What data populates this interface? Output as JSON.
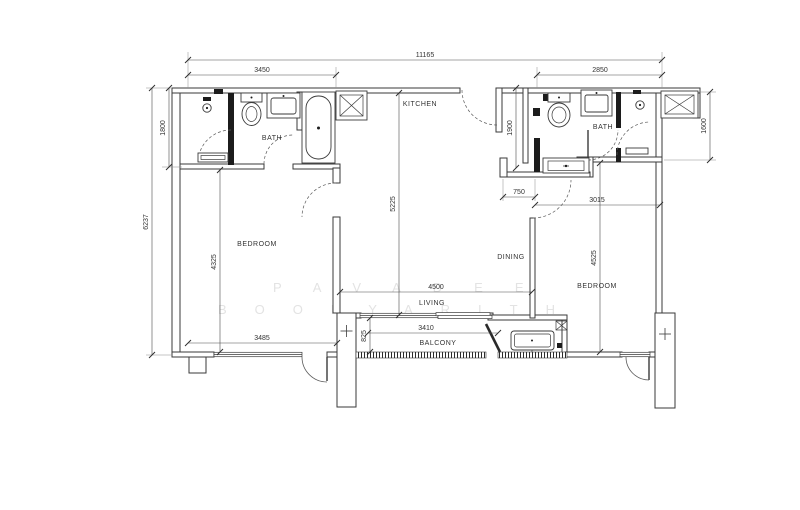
{
  "watermark": {
    "line1": "PAVADEE",
    "line2": "BOONYARITH"
  },
  "rooms": {
    "kitchen": "KITCHEN",
    "bath_left": "BATH",
    "bath_right": "BATH",
    "bedroom_left": "BEDROOM",
    "bedroom_right": "BEDROOM",
    "dining": "DINING",
    "living": "LIVING",
    "balcony": "BALCONY"
  },
  "dimensions_mm": {
    "overall_width": "11165",
    "left_section_width": "3450",
    "right_section_width": "2850",
    "overall_left_height": "6237",
    "bath_left_depth": "1800",
    "foyer_depth": "1900",
    "shaft_right_depth": "1600",
    "kitchen_living_depth": "5225",
    "bedroom_left_length": "4325",
    "bedroom_left_width": "3485",
    "living_width": "4500",
    "bedroom_right_door_offset": "750",
    "bedroom_right_width": "3015",
    "bedroom_right_length": "4525",
    "balcony_width": "3410",
    "balcony_depth": "825"
  },
  "fixtures": [
    "shower-head",
    "toilet",
    "sink",
    "bathtub",
    "shaft",
    "washer",
    "ac-unit",
    "column",
    "railing"
  ],
  "colors": {
    "line": "#3a3a3a",
    "dim_text": "#333333",
    "watermark": "#e3e3e3",
    "background": "#ffffff"
  }
}
